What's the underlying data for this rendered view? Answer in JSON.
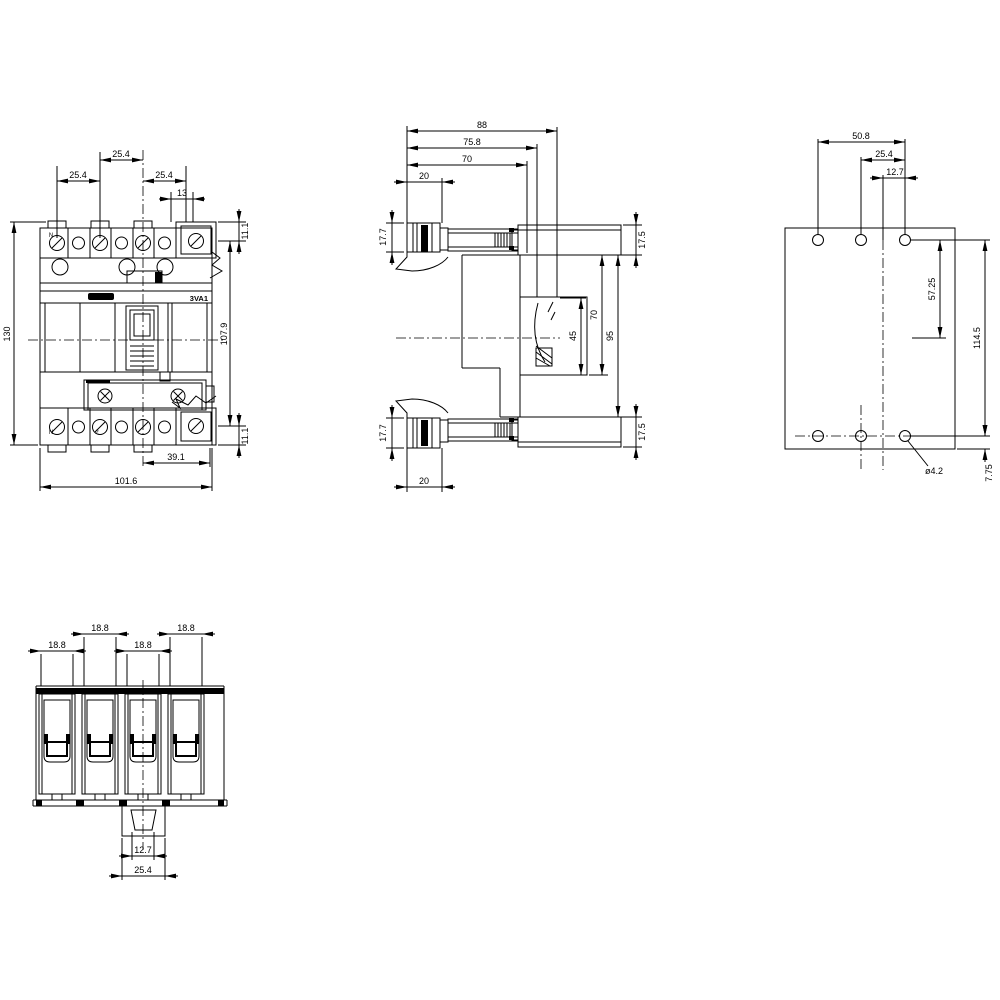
{
  "drawing": {
    "type": "dimensional-outline-drawing",
    "product_model": "3VA1",
    "views": {
      "front": {
        "dims": {
          "pitch_left": "25.4",
          "pitch_mid": "25.4",
          "pitch_right": "25.4",
          "terminal_width": "13",
          "terminal_offset_top": "11.1",
          "height": "130",
          "mount_height": "107.9",
          "terminal_offset_bottom": "11.1",
          "bottom_offset": "39.1",
          "width": "101.6"
        },
        "markings": {
          "model": "3VA1",
          "terminal_top_n": "N",
          "terminal_bottom_n": "N",
          "terminal_bottom_2": "2"
        }
      },
      "side": {
        "dims": {
          "depth_total": "88",
          "depth_rear": "75.8",
          "depth_case": "70",
          "front_step_top": "20",
          "terminal_height_top": "17.7",
          "bar_height_top": "17.5",
          "rear_window": "45",
          "rear_height": "70",
          "rear_clearance": "95",
          "terminal_height_bottom": "17.7",
          "bar_height_bottom": "17.5",
          "front_step_bottom": "20"
        }
      },
      "rear": {
        "dims": {
          "hole_span": "50.8",
          "hole_pitch": "25.4",
          "hole_to_center": "12.7",
          "upper_span": "57.25",
          "hole_row_span": "114.5",
          "edge_offset": "7.75",
          "hole_diameter": "ø4.2"
        }
      },
      "bottom": {
        "dims": {
          "pole1_width": "18.8",
          "pole2_width": "18.8",
          "pole3_width": "18.8",
          "pole4_width": "18.8",
          "clip_inner": "12.7",
          "clip_outer": "25.4"
        }
      }
    }
  }
}
